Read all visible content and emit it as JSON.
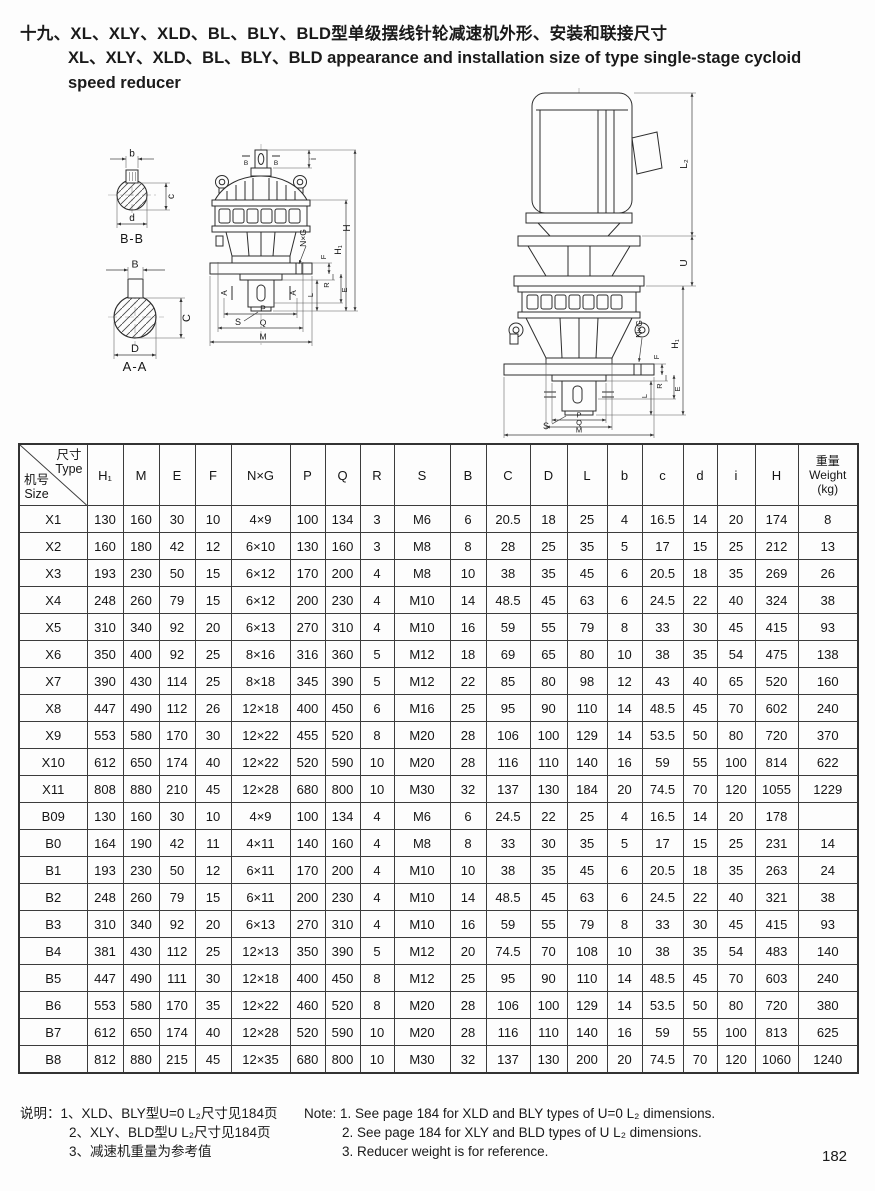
{
  "page": {
    "number": "182"
  },
  "title": {
    "zh": "十九、XL、XLY、XLD、BL、BLY、BLD型单级摆线针轮减速机外形、安装和联接尺寸",
    "en_line1": "XL、XLY、XLD、BL、BLY、BLD appearance and installation size of type single-stage cycloid",
    "en_line2": "speed reducer"
  },
  "drawings": {
    "labels": {
      "b": "b",
      "c": "c",
      "d": "d",
      "B": "B",
      "C": "C",
      "D": "D",
      "section_bb": "B-B",
      "section_aa": "A-A",
      "i": "i",
      "H": "H",
      "H1": "H₁",
      "NxG": "N×G",
      "F": "F",
      "R": "R",
      "E": "E",
      "L": "L",
      "S": "S",
      "P": "P",
      "Q": "Q",
      "M": "M",
      "L2": "L₂",
      "U": "U",
      "A": "A"
    }
  },
  "table": {
    "corner": {
      "top_zh": "尺寸",
      "top_en": "Type",
      "bottom_zh": "机号",
      "bottom_en": "Size"
    },
    "headers": [
      "H₁",
      "M",
      "E",
      "F",
      "N×G",
      "P",
      "Q",
      "R",
      "S",
      "B",
      "C",
      "D",
      "L",
      "b",
      "c",
      "d",
      "i",
      "H"
    ],
    "weight_header": {
      "zh": "重量",
      "en": "Weight",
      "unit": "(kg)"
    },
    "rows": [
      [
        "X1",
        "130",
        "160",
        "30",
        "10",
        "4×9",
        "100",
        "134",
        "3",
        "M6",
        "6",
        "20.5",
        "18",
        "25",
        "4",
        "16.5",
        "14",
        "20",
        "174",
        "8"
      ],
      [
        "X2",
        "160",
        "180",
        "42",
        "12",
        "6×10",
        "130",
        "160",
        "3",
        "M8",
        "8",
        "28",
        "25",
        "35",
        "5",
        "17",
        "15",
        "25",
        "212",
        "13"
      ],
      [
        "X3",
        "193",
        "230",
        "50",
        "15",
        "6×12",
        "170",
        "200",
        "4",
        "M8",
        "10",
        "38",
        "35",
        "45",
        "6",
        "20.5",
        "18",
        "35",
        "269",
        "26"
      ],
      [
        "X4",
        "248",
        "260",
        "79",
        "15",
        "6×12",
        "200",
        "230",
        "4",
        "M10",
        "14",
        "48.5",
        "45",
        "63",
        "6",
        "24.5",
        "22",
        "40",
        "324",
        "38"
      ],
      [
        "X5",
        "310",
        "340",
        "92",
        "20",
        "6×13",
        "270",
        "310",
        "4",
        "M10",
        "16",
        "59",
        "55",
        "79",
        "8",
        "33",
        "30",
        "45",
        "415",
        "93"
      ],
      [
        "X6",
        "350",
        "400",
        "92",
        "25",
        "8×16",
        "316",
        "360",
        "5",
        "M12",
        "18",
        "69",
        "65",
        "80",
        "10",
        "38",
        "35",
        "54",
        "475",
        "138"
      ],
      [
        "X7",
        "390",
        "430",
        "114",
        "25",
        "8×18",
        "345",
        "390",
        "5",
        "M12",
        "22",
        "85",
        "80",
        "98",
        "12",
        "43",
        "40",
        "65",
        "520",
        "160"
      ],
      [
        "X8",
        "447",
        "490",
        "112",
        "26",
        "12×18",
        "400",
        "450",
        "6",
        "M16",
        "25",
        "95",
        "90",
        "110",
        "14",
        "48.5",
        "45",
        "70",
        "602",
        "240"
      ],
      [
        "X9",
        "553",
        "580",
        "170",
        "30",
        "12×22",
        "455",
        "520",
        "8",
        "M20",
        "28",
        "106",
        "100",
        "129",
        "14",
        "53.5",
        "50",
        "80",
        "720",
        "370"
      ],
      [
        "X10",
        "612",
        "650",
        "174",
        "40",
        "12×22",
        "520",
        "590",
        "10",
        "M20",
        "28",
        "116",
        "110",
        "140",
        "16",
        "59",
        "55",
        "100",
        "814",
        "622"
      ],
      [
        "X11",
        "808",
        "880",
        "210",
        "45",
        "12×28",
        "680",
        "800",
        "10",
        "M30",
        "32",
        "137",
        "130",
        "184",
        "20",
        "74.5",
        "70",
        "120",
        "1055",
        "1229"
      ],
      [
        "B09",
        "130",
        "160",
        "30",
        "10",
        "4×9",
        "100",
        "134",
        "4",
        "M6",
        "6",
        "24.5",
        "22",
        "25",
        "4",
        "16.5",
        "14",
        "20",
        "178",
        ""
      ],
      [
        "B0",
        "164",
        "190",
        "42",
        "11",
        "4×11",
        "140",
        "160",
        "4",
        "M8",
        "8",
        "33",
        "30",
        "35",
        "5",
        "17",
        "15",
        "25",
        "231",
        "14"
      ],
      [
        "B1",
        "193",
        "230",
        "50",
        "12",
        "6×11",
        "170",
        "200",
        "4",
        "M10",
        "10",
        "38",
        "35",
        "45",
        "6",
        "20.5",
        "18",
        "35",
        "263",
        "24"
      ],
      [
        "B2",
        "248",
        "260",
        "79",
        "15",
        "6×11",
        "200",
        "230",
        "4",
        "M10",
        "14",
        "48.5",
        "45",
        "63",
        "6",
        "24.5",
        "22",
        "40",
        "321",
        "38"
      ],
      [
        "B3",
        "310",
        "340",
        "92",
        "20",
        "6×13",
        "270",
        "310",
        "4",
        "M10",
        "16",
        "59",
        "55",
        "79",
        "8",
        "33",
        "30",
        "45",
        "415",
        "93"
      ],
      [
        "B4",
        "381",
        "430",
        "112",
        "25",
        "12×13",
        "350",
        "390",
        "5",
        "M12",
        "20",
        "74.5",
        "70",
        "108",
        "10",
        "38",
        "35",
        "54",
        "483",
        "140"
      ],
      [
        "B5",
        "447",
        "490",
        "111",
        "30",
        "12×18",
        "400",
        "450",
        "8",
        "M12",
        "25",
        "95",
        "90",
        "110",
        "14",
        "48.5",
        "45",
        "70",
        "603",
        "240"
      ],
      [
        "B6",
        "553",
        "580",
        "170",
        "35",
        "12×22",
        "460",
        "520",
        "8",
        "M20",
        "28",
        "106",
        "100",
        "129",
        "14",
        "53.5",
        "50",
        "80",
        "720",
        "380"
      ],
      [
        "B7",
        "612",
        "650",
        "174",
        "40",
        "12×28",
        "520",
        "590",
        "10",
        "M20",
        "28",
        "116",
        "110",
        "140",
        "16",
        "59",
        "55",
        "100",
        "813",
        "625"
      ],
      [
        "B8",
        "812",
        "880",
        "215",
        "45",
        "12×35",
        "680",
        "800",
        "10",
        "M30",
        "32",
        "137",
        "130",
        "200",
        "20",
        "74.5",
        "70",
        "120",
        "1060",
        "1240"
      ]
    ]
  },
  "notes": {
    "zh_label": "说明：",
    "zh1": "1、XLD、BLY型U=0 L₂尺寸见184页",
    "zh2": "2、XLY、BLD型U L₂尺寸见184页",
    "zh3": "3、减速机重量为参考值",
    "en_label": "Note:",
    "en1": "1. See page 184 for XLD and BLY types of U=0 L₂ dimensions.",
    "en2": "2. See page 184 for XLY and BLD types of U L₂ dimensions.",
    "en3": "3. Reducer weight is for reference."
  }
}
